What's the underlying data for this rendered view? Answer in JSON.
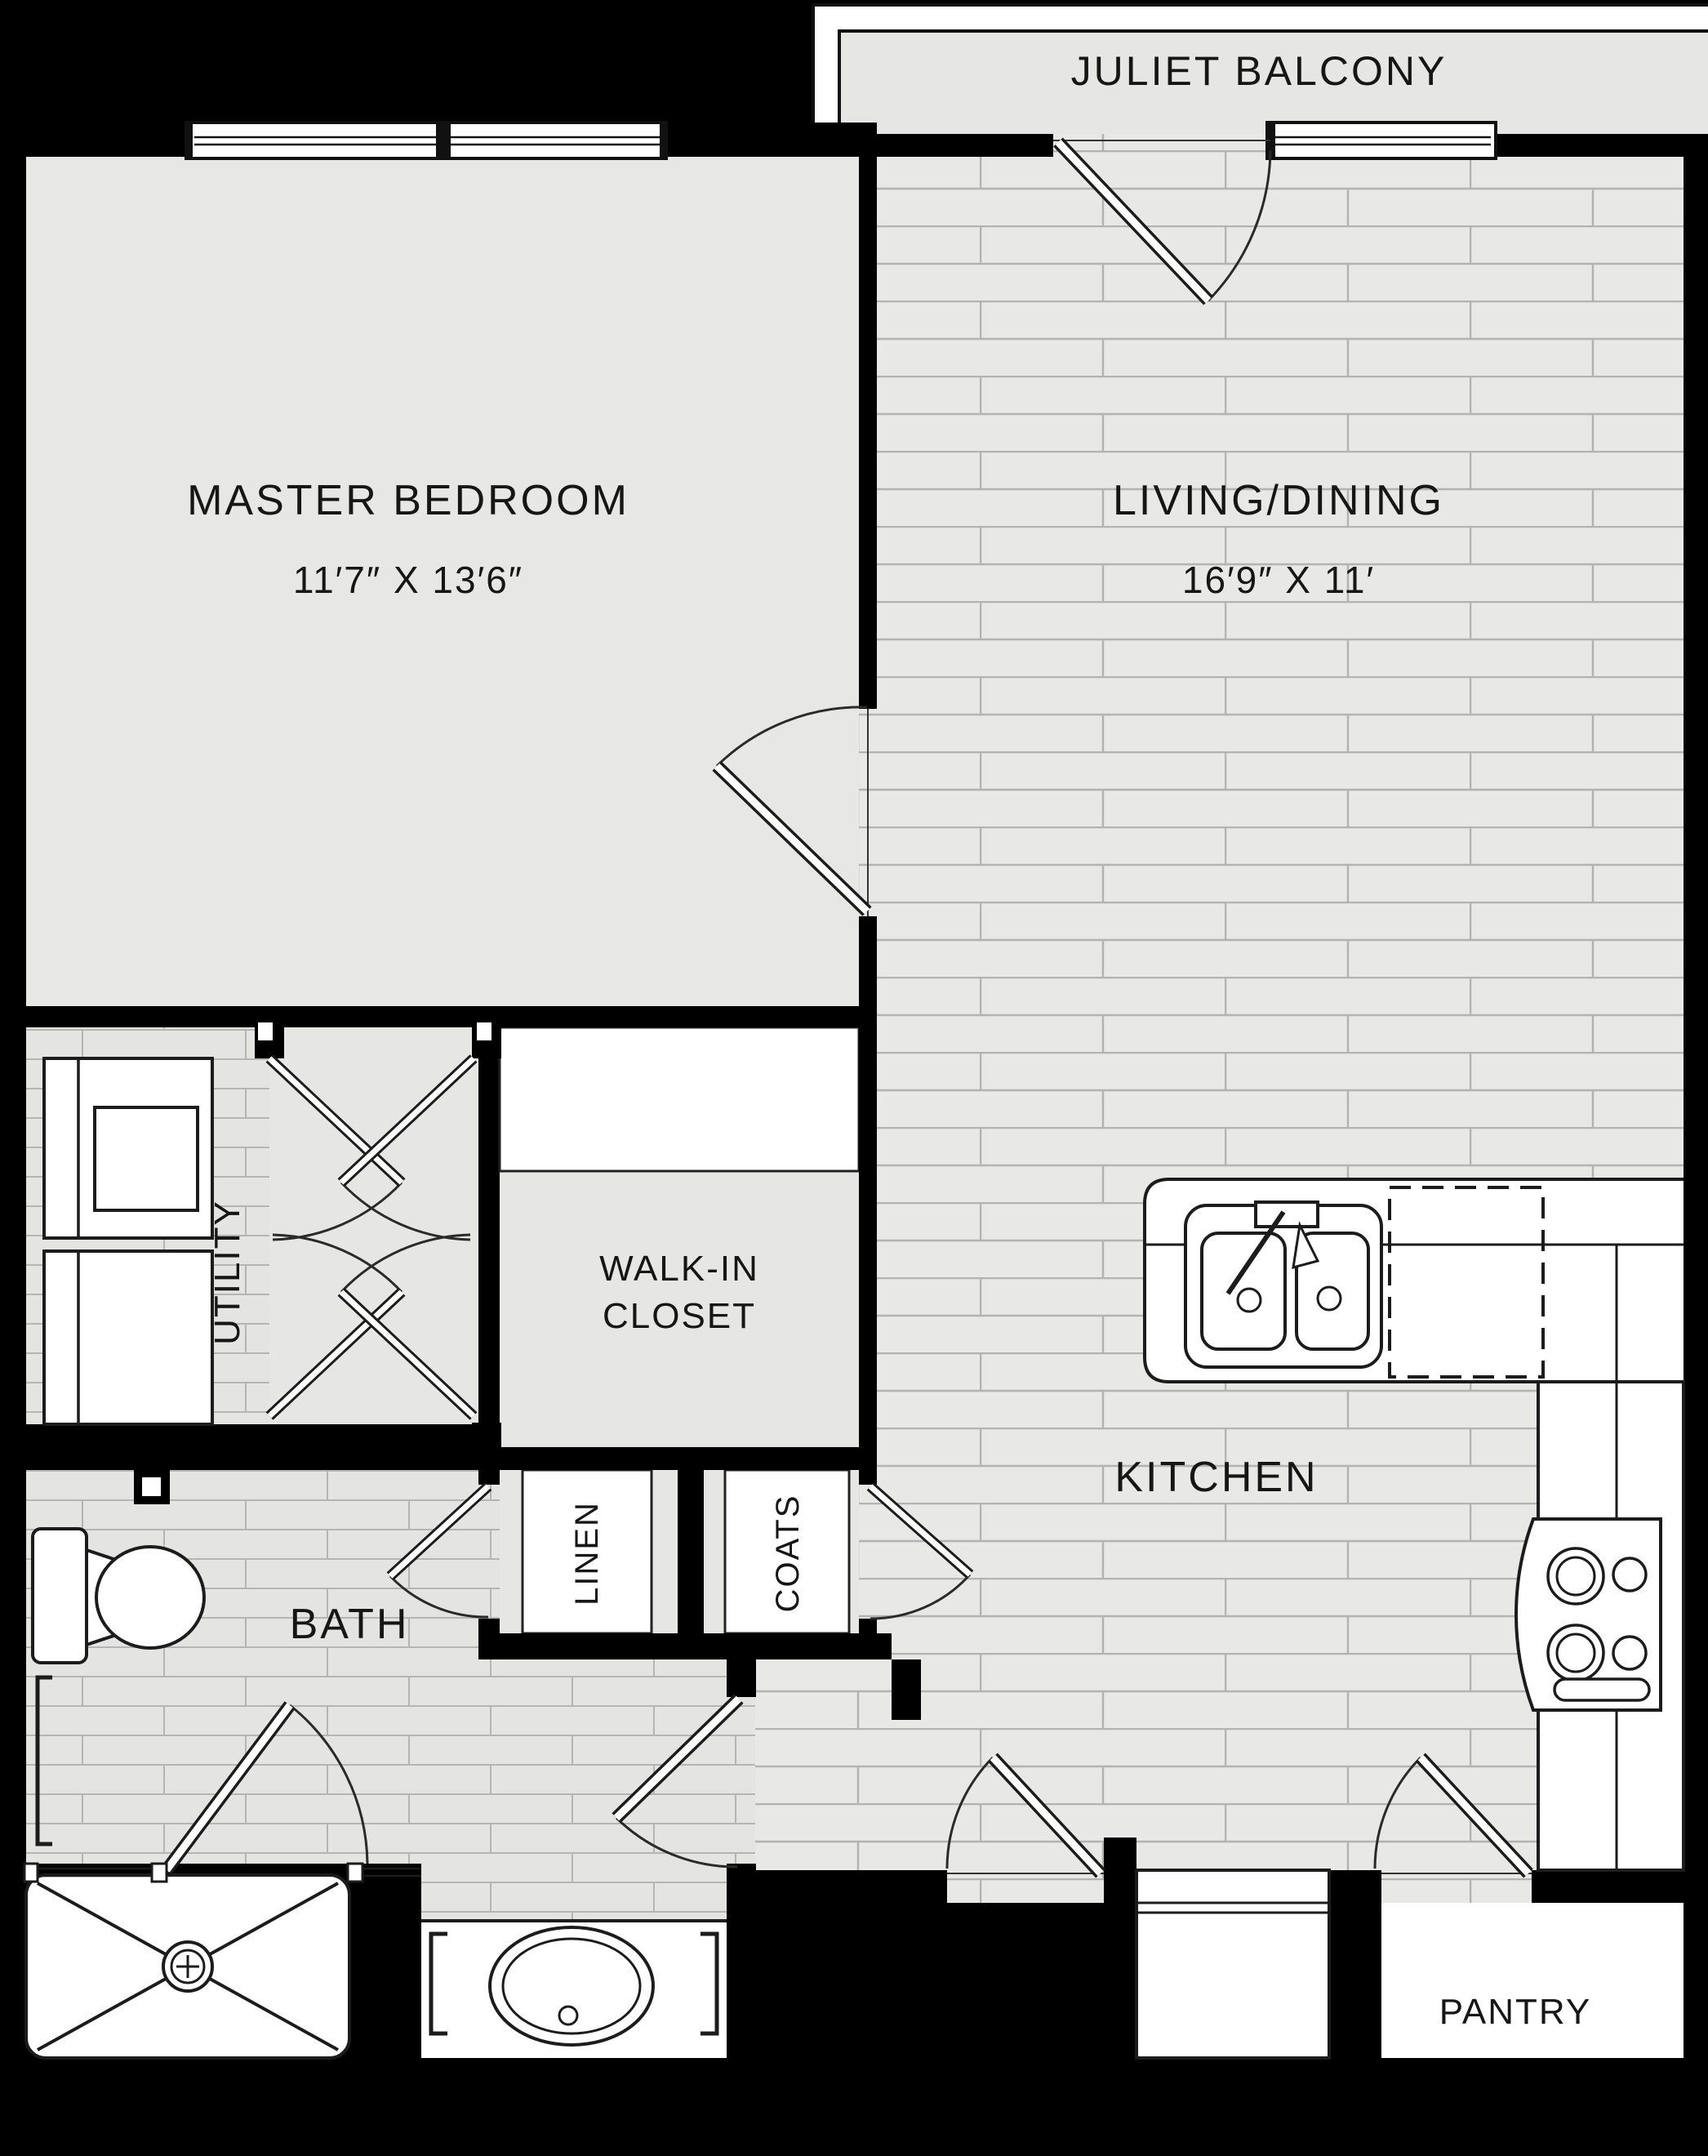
{
  "floorplan": {
    "balcony": {
      "label": "JULIET BALCONY"
    },
    "rooms": {
      "master_bedroom": {
        "label": "MASTER BEDROOM",
        "dims": "11′7″ X 13′6″"
      },
      "living_dining": {
        "label": "LIVING/DINING",
        "dims": "16′9″ X 11′"
      },
      "kitchen": {
        "label": "KITCHEN"
      },
      "bath": {
        "label": "BATH"
      },
      "pantry": {
        "label": "PANTRY"
      },
      "utility": {
        "label": "UTILITY"
      },
      "walk_in_closet": {
        "label_line1": "WALK-IN",
        "label_line2": "CLOSET"
      },
      "linen": {
        "label": "LINEN"
      },
      "coats": {
        "label": "COATS"
      }
    },
    "colors": {
      "wall": "#000000",
      "floor": "#e7e7e6",
      "floor_line": "#b3b3b2",
      "fixture": "#ffffff",
      "outline": "#1c1c1c"
    }
  }
}
